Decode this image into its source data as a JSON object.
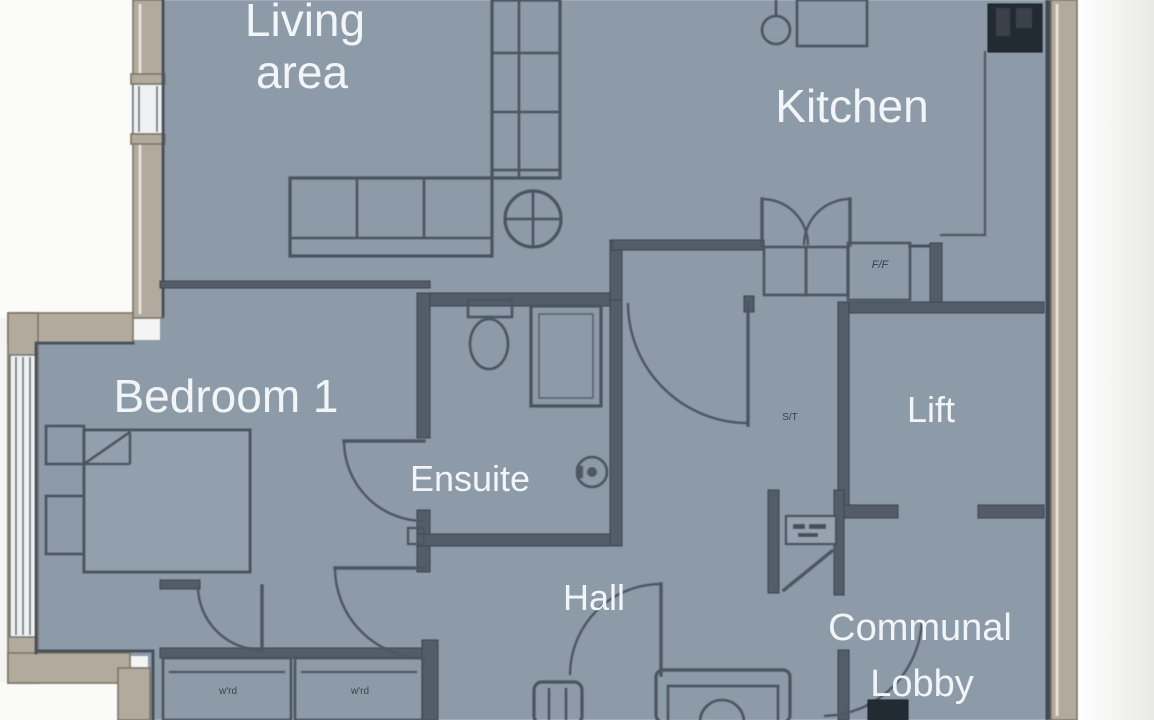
{
  "title": "Apartment floor plan",
  "colors": {
    "floor": "#8d9aa7",
    "wall_line": "#47525e",
    "outer_band": "#b2aa9c",
    "outside": "#f4f4f3",
    "label_text": "#f2f5f8"
  },
  "rooms": {
    "living_area": {
      "label_line1": "Living",
      "label_line2": "area"
    },
    "kitchen": {
      "label": "Kitchen"
    },
    "bedroom_1": {
      "label": "Bedroom 1"
    },
    "ensuite": {
      "label": "Ensuite"
    },
    "hall": {
      "label": "Hall"
    },
    "lift": {
      "label": "Lift"
    },
    "communal_lobby": {
      "label_line1": "Communal",
      "label_line2": "Lobby"
    }
  },
  "annotations": {
    "fridge_freezer": "F/F",
    "store": "S/T",
    "wardrobe_left": "w'rd",
    "wardrobe_right": "w'rd"
  }
}
